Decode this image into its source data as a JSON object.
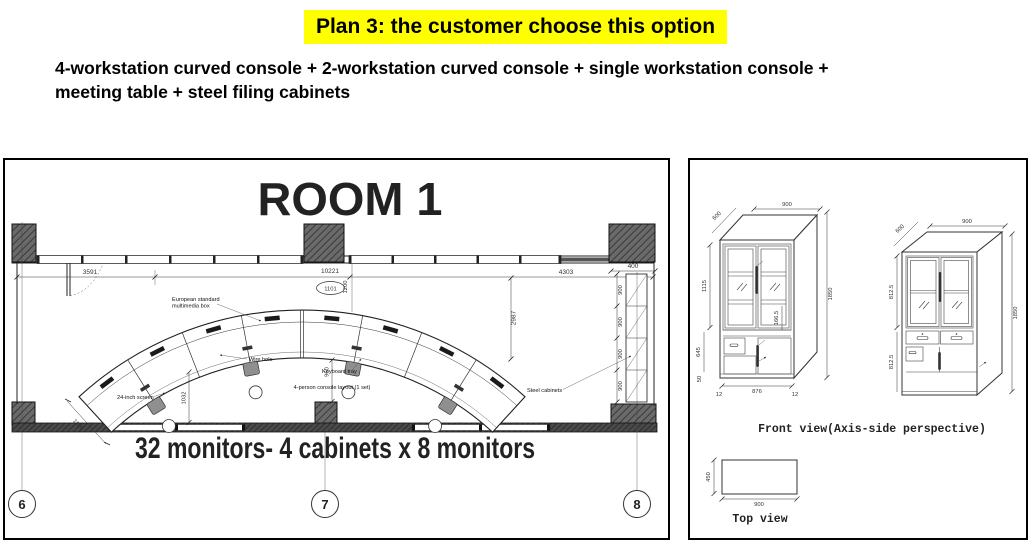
{
  "header": {
    "title": "Plan 3: the customer choose this option",
    "highlight_color": "#ffff00",
    "subtitle_line1": "4-workstation curved console + 2-workstation curved console + single workstation console +",
    "subtitle_line2": "meeting table + steel filing cabinets"
  },
  "room_plan": {
    "room_title": "ROOM 1",
    "caption": "32 monitors- 4 cabinets x 8 monitors",
    "grid_bubbles": [
      "6",
      "7",
      "8"
    ],
    "dimensions": {
      "wall_left": "3591",
      "wall_total": "10221",
      "console_tag": "1101",
      "wall_gap": "1200",
      "console_to_wall": "2987",
      "wall_right": "4303",
      "cabinet_depth": "400",
      "cabinet_widths": [
        "900",
        "900",
        "900",
        "900"
      ],
      "console_end": "1000",
      "console_clearance": "1032",
      "console_front": "960"
    },
    "labels": {
      "multimedia_line1": "European standard",
      "multimedia_line2": "multimedia box",
      "wire_hole": "Wire hole",
      "keyboard_tray": "Keyboard tray",
      "screen": "24-inch screen",
      "console_layout": "4-person console layout (1 set)",
      "steel_cabinets": "Steel cabinets"
    }
  },
  "cabinet_views": {
    "front_view_label": "Front view(Axis-side perspective)",
    "top_view_label": "Top view",
    "left_cabinet": {
      "width": "900",
      "depth": "600",
      "upper_height": "1115",
      "total_height": "1850",
      "lower_height": "645",
      "base_height": "50",
      "inner_width": "876",
      "edge_left": "12",
      "edge_right": "12",
      "detail": "166.5"
    },
    "right_cabinet": {
      "width": "900",
      "depth": "600",
      "upper_height": "812.5",
      "lower_height": "812.5",
      "total_height": "1850"
    },
    "top_view": {
      "width": "900",
      "depth": "450"
    }
  }
}
